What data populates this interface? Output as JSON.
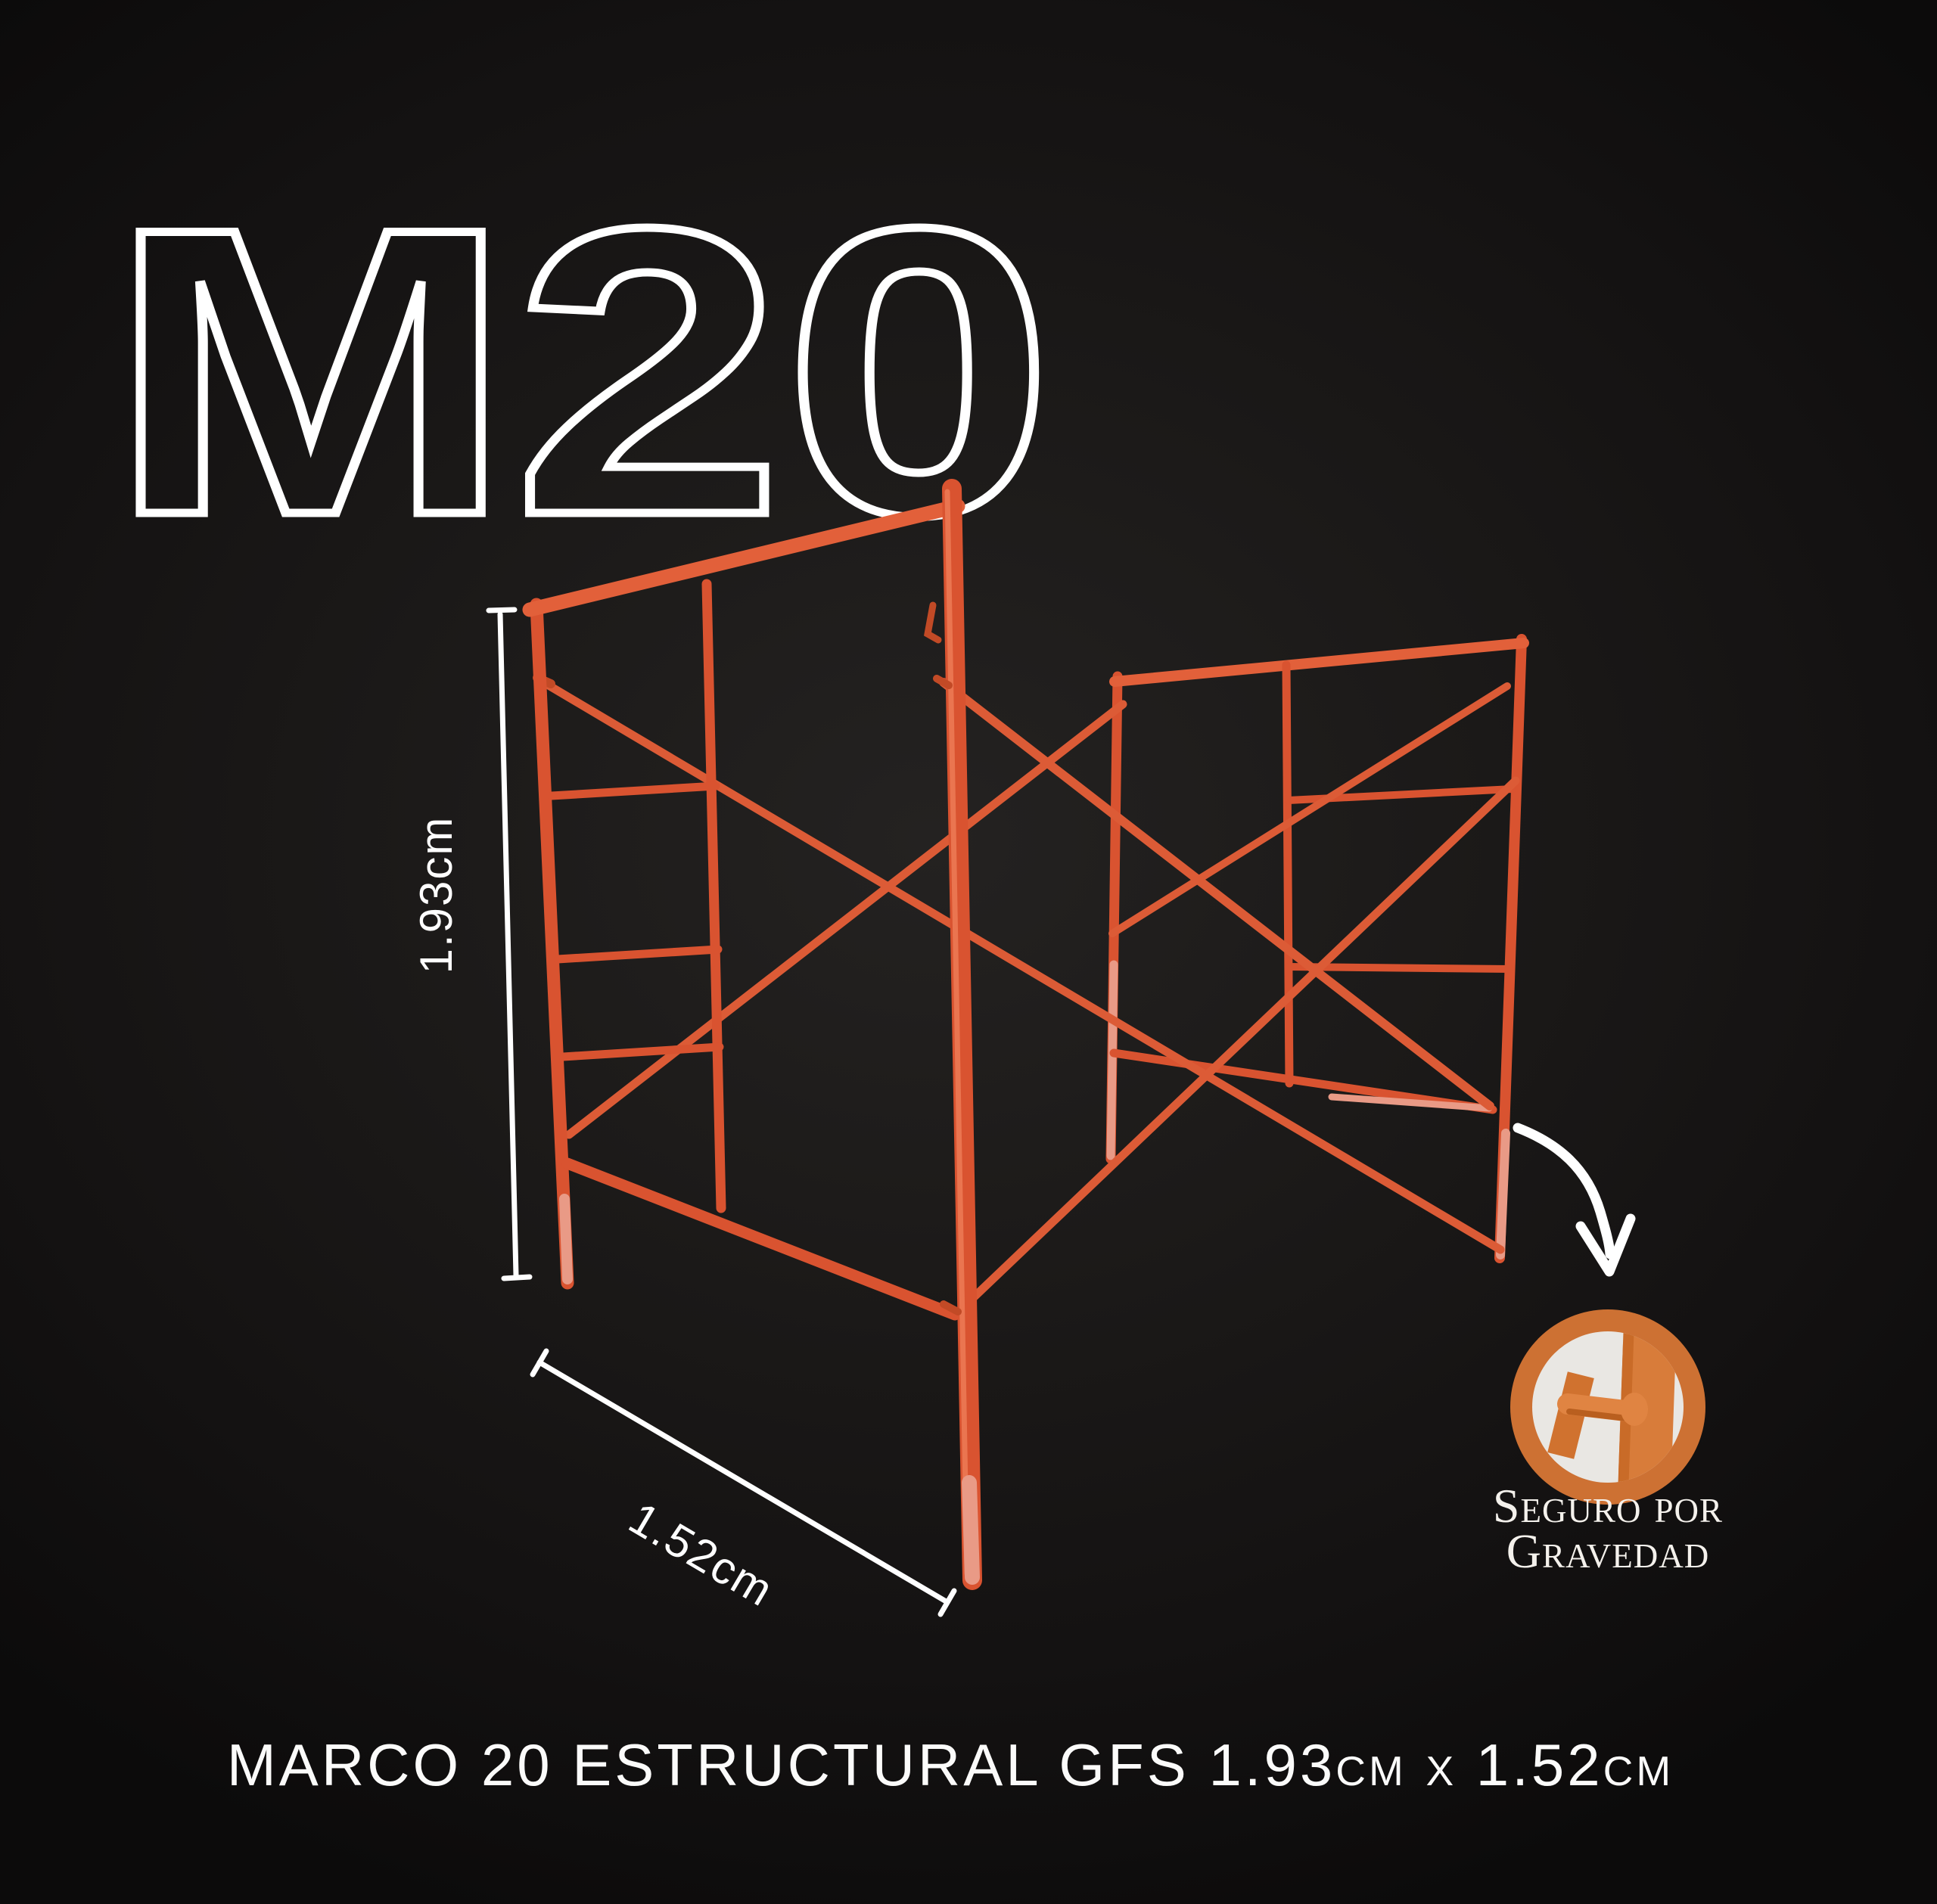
{
  "product": {
    "model_code": "M20",
    "title": "MARCO 20 ESTRUCTURAL GFS 1.93cm x 1.52cm"
  },
  "dimensions": {
    "height_label": "1.93cm",
    "width_label": "1.52cm"
  },
  "badge": {
    "caption_line1": "Seguro por",
    "caption_line2": "Gravedad"
  },
  "icons": {
    "arrow": "curved-arrow-icon",
    "badge": "gravity-lock-badge"
  },
  "colors": {
    "background_center": "#242221",
    "background_edge": "#0c0b0b",
    "tube_main": "#d95330",
    "tube_light": "#e2603a",
    "tube_pink": "#e99a86",
    "badge_ring": "#cd7133",
    "badge_face": "#e9e7e3",
    "pin_orange": "#e08442",
    "pin_shadow": "#b95f1f",
    "plate_orange": "#d0722f",
    "annotation_white": "#ffffff"
  }
}
